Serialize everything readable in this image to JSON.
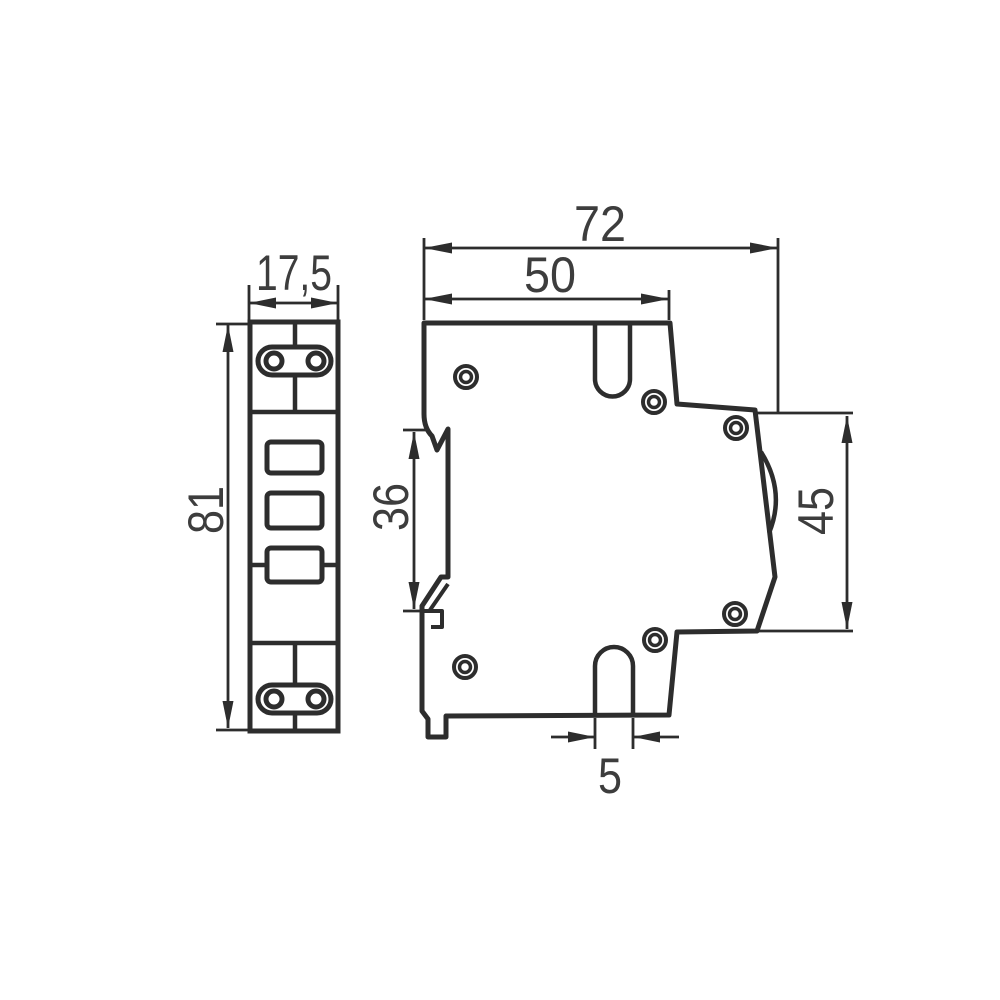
{
  "drawing": {
    "views": {
      "front": {
        "label_width": "17,5",
        "label_height": "81"
      },
      "side": {
        "label_depth_total": "72",
        "label_depth_upper": "50",
        "label_rail_channel": "36",
        "label_rear_height": "45",
        "label_slot_width": "5"
      }
    },
    "colors": {
      "line": "#2d2d2d",
      "label": "#3d3d3d",
      "background": "#ffffff"
    }
  }
}
